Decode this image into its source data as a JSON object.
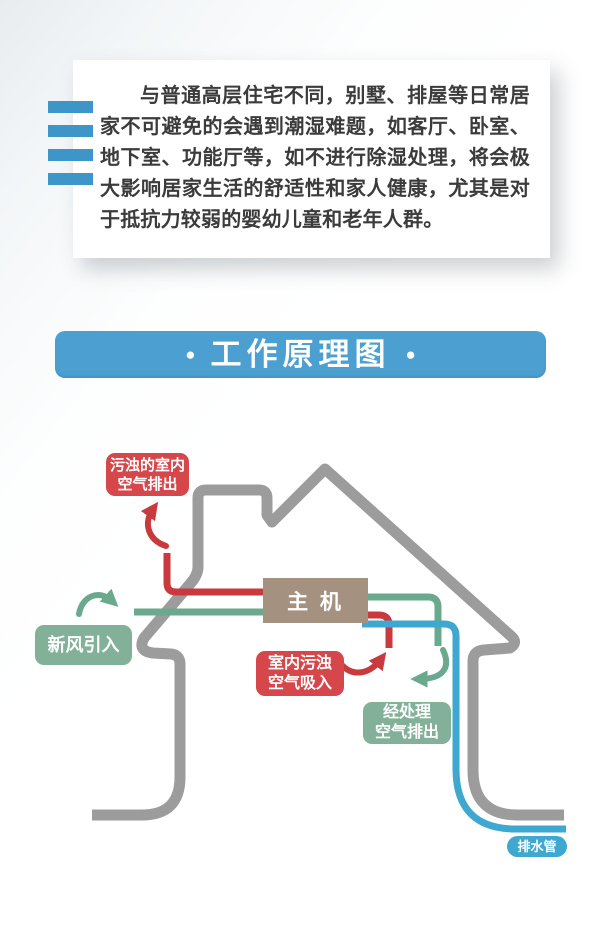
{
  "intro_card": {
    "paragraph": "与普通高层住宅不同，别墅、排屋等日常居家不可避免的会遇到潮湿难题，如客厅、卧室、地下室、功能厅等，如不进行除湿处理，将会极大影响居家生活的舒适性和家人健康，尤其是对于抵抗力较弱的婴幼儿童和老年人群。"
  },
  "decor": {
    "bar_color": "#3e95c7"
  },
  "banner": {
    "title": "工作原理图",
    "bullet": "●",
    "bg_color": "#4c9fd1"
  },
  "diagram": {
    "main_unit": {
      "label": "主 机",
      "bg_color": "#a5917f"
    },
    "labels": {
      "dirty_air_exhaust": {
        "text": "污浊的室内\n空气排出",
        "bg_color": "#d5474b"
      },
      "fresh_air_intake": {
        "text": "新风引入",
        "bg_color": "#82b098"
      },
      "indoor_dirty_intake": {
        "text": "室内污浊\n空气吸入",
        "bg_color": "#d5474b"
      },
      "treated_air_exhaust": {
        "text": "经处理\n空气排出",
        "bg_color": "#82b098"
      },
      "drain_pipe": {
        "text": "排水管",
        "bg_color": "#3ea8d1"
      }
    },
    "colors": {
      "house_outline": "#9c9c9c",
      "dirty_air_pipe": "#c9393d",
      "fresh_air_pipe": "#6aa98d",
      "drain_water_pipe": "#3ea8d1"
    }
  }
}
